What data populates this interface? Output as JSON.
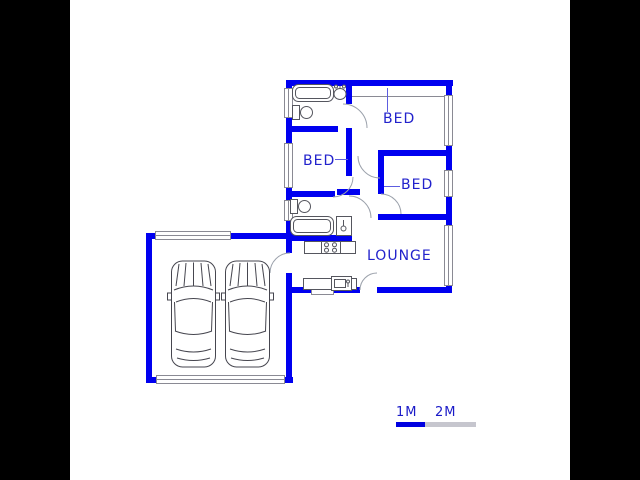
{
  "document": {
    "type": "architectural floor plan drawing"
  },
  "colors": {
    "wall": "#0000f0",
    "room_label": "#2222cc",
    "door_arc": "#9ba1ab",
    "fixture_outline": "#55565e",
    "window_outline": "#8a8a94",
    "leader_line": "#5d5de0",
    "scale_blue": "#0000e0",
    "scale_gray": "#c6c6ce",
    "letterbox": "#000000",
    "background": "#ffffff"
  },
  "rooms": [
    {
      "id": "bedroom-top",
      "label": "BED"
    },
    {
      "id": "bedroom-middle",
      "label": "BED"
    },
    {
      "id": "bedroom-right",
      "label": "BED"
    },
    {
      "id": "lounge",
      "label": "LOUNGE"
    }
  ],
  "garage": {
    "cars": 2
  },
  "fixtures": [
    "bathtub",
    "basin",
    "toilet",
    "toilet",
    "bathtub",
    "shower",
    "stove",
    "kitchen-sink",
    "under-counter-appliance",
    "car",
    "car"
  ],
  "scale_bar": {
    "labels": [
      "1M",
      "2M"
    ]
  }
}
